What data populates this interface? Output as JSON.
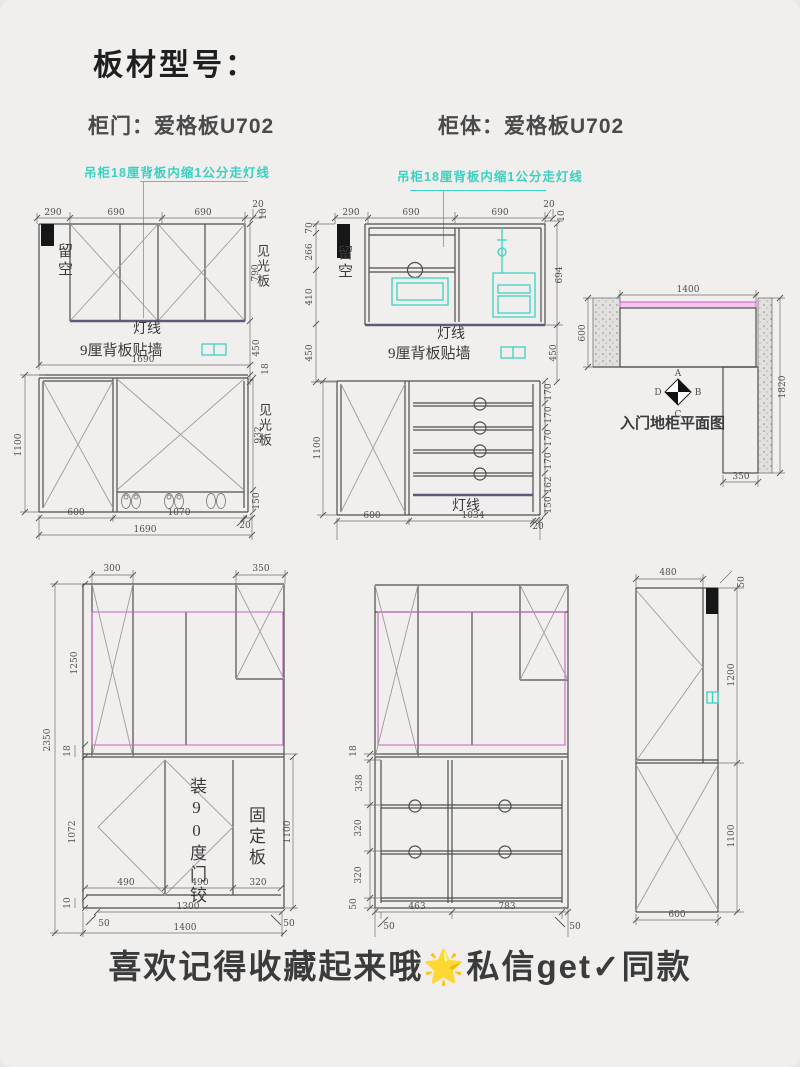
{
  "header": {
    "title": "板材型号：",
    "door_spec": "柜门：爱格板U702",
    "body_spec": "柜体：爱格板U702"
  },
  "notes": {
    "wall_cabinet": "吊柜18厘背板内缩1公分走灯线"
  },
  "shared": {
    "liukong": "留空",
    "dengxian": "灯线",
    "backpanel": "9厘背板贴墙",
    "jianguang": "见光板"
  },
  "d1": {
    "top": [
      "290",
      "690",
      "690",
      "20"
    ],
    "top_right_10": "10",
    "right_790": "790",
    "right_450": "450",
    "right_18": "18",
    "mid_1690": "1690",
    "left_1100": "1100",
    "right_932": "932",
    "right_150": "150",
    "bot_600": "600",
    "bot_1070": "1070",
    "bot_20": "20",
    "bot_1690": "1690"
  },
  "d2": {
    "top": [
      "290",
      "690",
      "690",
      "20"
    ],
    "top_right_10": "10",
    "left": [
      "70",
      "266",
      "410",
      "450"
    ],
    "right_694": "694",
    "right_450": "450",
    "left_1100": "1100",
    "right_chain": [
      "170",
      "170",
      "170",
      "170",
      "162",
      "150"
    ],
    "bot_600": "600",
    "bot_1034": "1034",
    "bot_20": "20"
  },
  "plan": {
    "top_1400": "1400",
    "left_600": "600",
    "right_1820": "1820",
    "bot_350": "350",
    "compass": [
      "A",
      "B",
      "C",
      "D"
    ],
    "caption": "入门地柜平面图"
  },
  "d4": {
    "top_300": "300",
    "top_350": "350",
    "left_2350": "2350",
    "left_1250": "1250",
    "left_18": "18",
    "left_1072": "1072",
    "left_10": "10",
    "right_1100": "1100",
    "inner": [
      "490",
      "490",
      "320"
    ],
    "bot_1300": "1300",
    "bot_50l": "50",
    "bot_50r": "50",
    "bot_1400": "1400",
    "hinge_note": "装90度门铰",
    "fixed_note": "固定板"
  },
  "d5": {
    "left_18": "18",
    "left_338": "338",
    "left_320a": "320",
    "left_320b": "320",
    "left_50": "50",
    "bot_463": "463",
    "bot_783": "783",
    "bot_50l": "50",
    "bot_50r": "50"
  },
  "d6": {
    "top_480": "480",
    "right_50": "50",
    "right_1200": "1200",
    "right_1100": "1100",
    "bot_600": "600"
  },
  "footer": {
    "text": "喜欢记得收藏起来哦🌟私信get✓同款"
  },
  "colors": {
    "teal": "#3ad1c1",
    "magenta": "#c95fc0",
    "pink_fill": "#f6c6ef",
    "line_dark": "#4a4a4a",
    "paper": "#f1efed"
  }
}
